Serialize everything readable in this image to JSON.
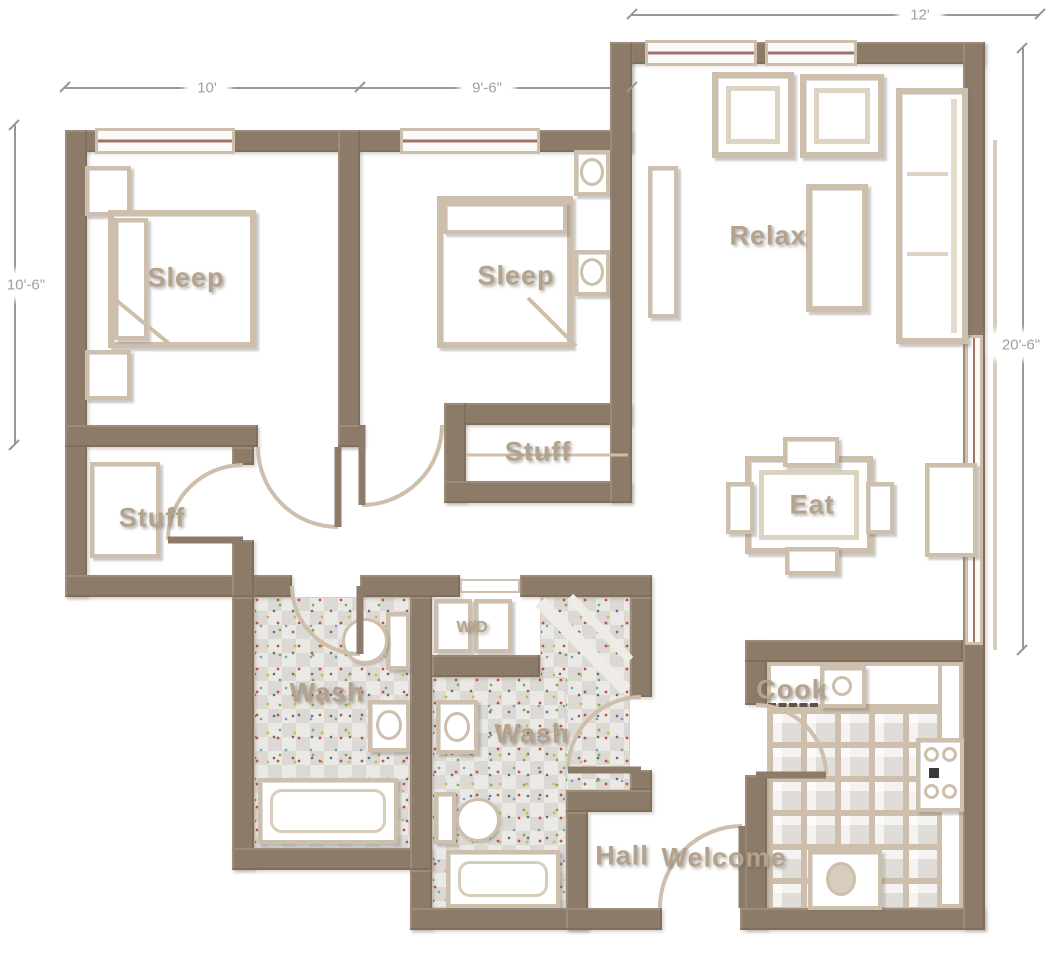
{
  "floor_plan": {
    "dimensions": {
      "top_left": "10'",
      "top_middle": "9'-6\"",
      "top_right": "12'",
      "left_side": "10'-6\"",
      "right_side": "20'-6\""
    },
    "rooms": {
      "bedroom_1": "Sleep",
      "bedroom_2": "Sleep",
      "living_room": "Relax",
      "dining": "Eat",
      "closet_left": "Stuff",
      "closet_right": "Stuff",
      "bathroom_1": "Wash",
      "bathroom_2": "Wash",
      "laundry": "W/D",
      "kitchen": "Cook",
      "hall": "Hall",
      "entry": "Welcome"
    },
    "colors": {
      "wall": "#8c7b68",
      "furniture_outline": "#cdbfab",
      "room_label": "#b4a28c",
      "dimension_text": "#a3a09b",
      "window_mullion": "#a0706b",
      "floor_tile_grout": "#cdbfab"
    }
  }
}
